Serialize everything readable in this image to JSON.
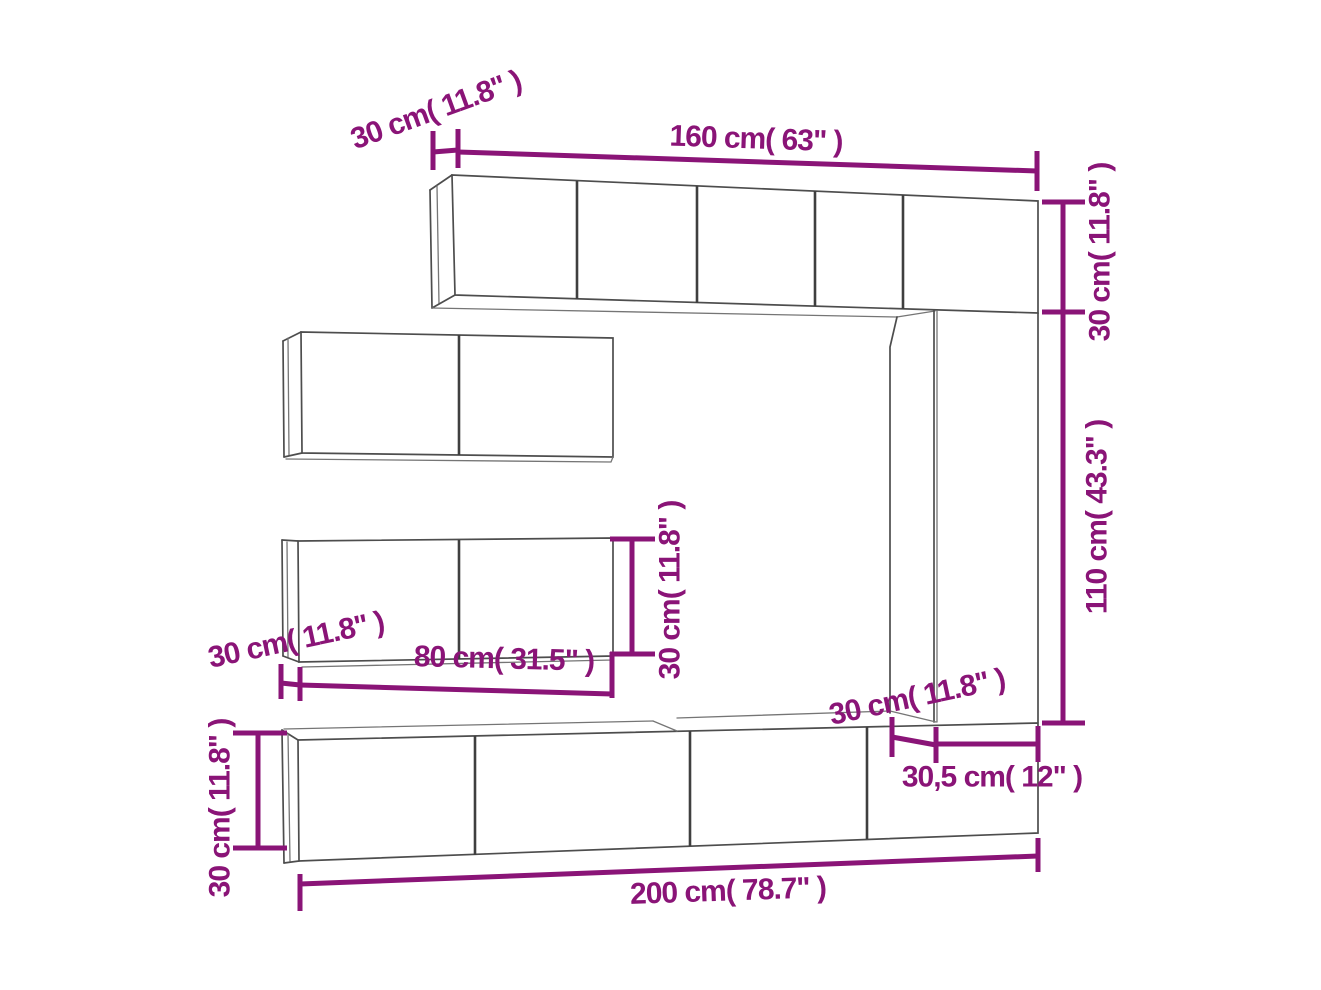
{
  "diagram": {
    "kind": "furniture-dimension-line-drawing",
    "subject": "Wall-mounted TV cabinet set with dimension annotations"
  },
  "colors": {
    "dimension_annotation": "#8a1477",
    "outline": "#4d4d4d",
    "background": "#ffffff"
  },
  "labels": {
    "top_left_depth": "30 cm( 11.8\" )",
    "top_width": "160 cm( 63\" )",
    "right_upper_height": "30 cm( 11.8\" )",
    "right_lower_height": "110 cm( 43.3\" )",
    "middle_cabinet_height": "30 cm( 11.8\" )",
    "middle_cabinet_depth": "30 cm( 11.8\" )",
    "middle_cabinet_width": "80 cm( 31.5\" )",
    "column_side_depth": "30 cm( 11.8\" )",
    "column_front_width": "30,5 cm( 12\" )",
    "bottom_cabinet_height": "30 cm( 11.8\" )",
    "bottom_width": "200 cm( 78.7\" )"
  }
}
